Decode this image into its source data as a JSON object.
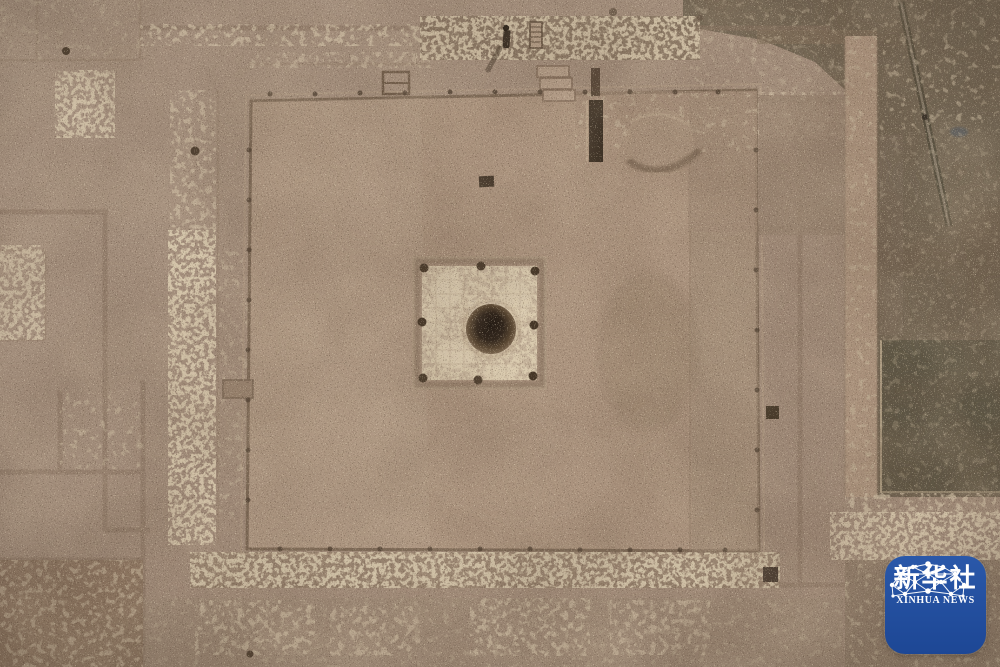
{
  "meta": {
    "type": "aerial-photograph",
    "subject": "Top-down aerial photograph of an archaeological excavation: a large square rammed-earth platform foundation with a central square pit and round well shaft, surrounded by excavation trenches, rubble bands and an unexcavated dark strip on the right"
  },
  "watermark": {
    "name_cn": "新华社",
    "name_en": "XINHUA NEWS",
    "background": "#24509f",
    "foreground": "#ffffff"
  },
  "scene": {
    "palette": {
      "ground": "#a28c7a",
      "platform": "#ac947f",
      "pit_fill": "#c6b49c",
      "well_dark": "#241b13",
      "dark_terrain": "#756856",
      "dark_green_pit": "#5f5847",
      "rubble_light": "#d7c7ac",
      "trench": "#8a7462"
    },
    "features": [
      {
        "name": "excavation-platform",
        "desc": "large square rammed-earth foundation"
      },
      {
        "name": "central-pit",
        "desc": "square pit with white rubble fill"
      },
      {
        "name": "well-shaft",
        "desc": "dark circular well opening at pit center"
      },
      {
        "name": "trench-grid",
        "desc": "excavation trench lines and rubble wall footings"
      },
      {
        "name": "unexcavated-strip",
        "desc": "dark unexcavated terrain along right edge with diagonal track"
      },
      {
        "name": "person",
        "desc": "tiny figure standing at top center with ladder and steps"
      }
    ]
  }
}
